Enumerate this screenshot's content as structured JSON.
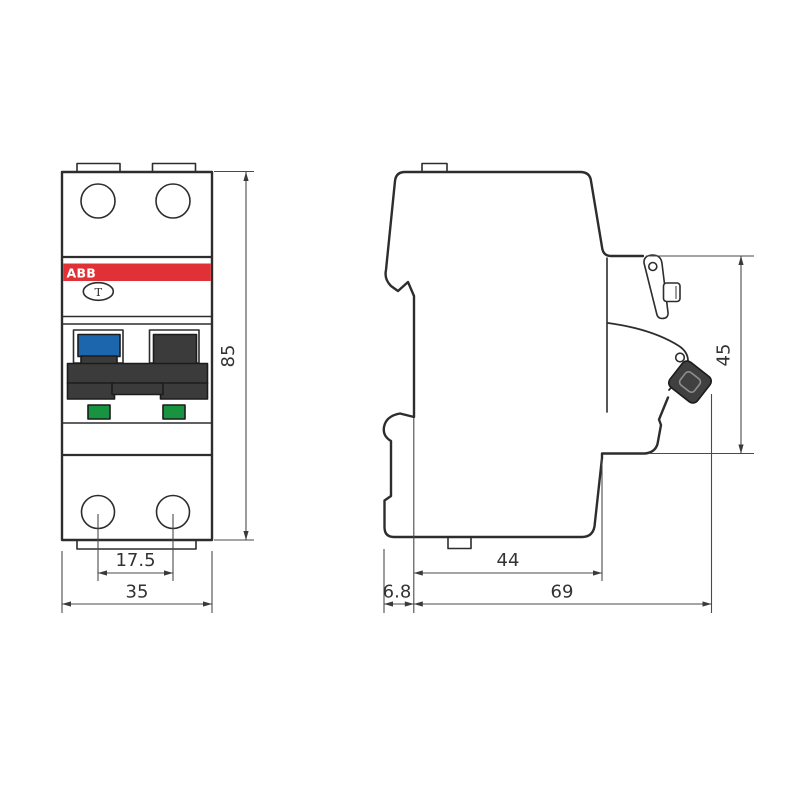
{
  "drawing": {
    "brand": "ABB",
    "test_button": "T"
  },
  "front_view": {
    "dim_pole_spacing": "17.5",
    "dim_width": "35",
    "dim_height": "85"
  },
  "side_view": {
    "dim_rail_offset": "6.8",
    "dim_depth_to_rail": "44",
    "dim_total_depth": "69",
    "dim_front_height": "45"
  },
  "colors": {
    "brand_red": "#e03236",
    "toggle_blue": "#1b66ad",
    "indicator_green": "#189440",
    "handle_dark": "#3b3b3b",
    "lever_dark": "#404040",
    "outline": "#2d2d2d",
    "dimension_line": "#4a4a4a",
    "background": "#ffffff"
  }
}
